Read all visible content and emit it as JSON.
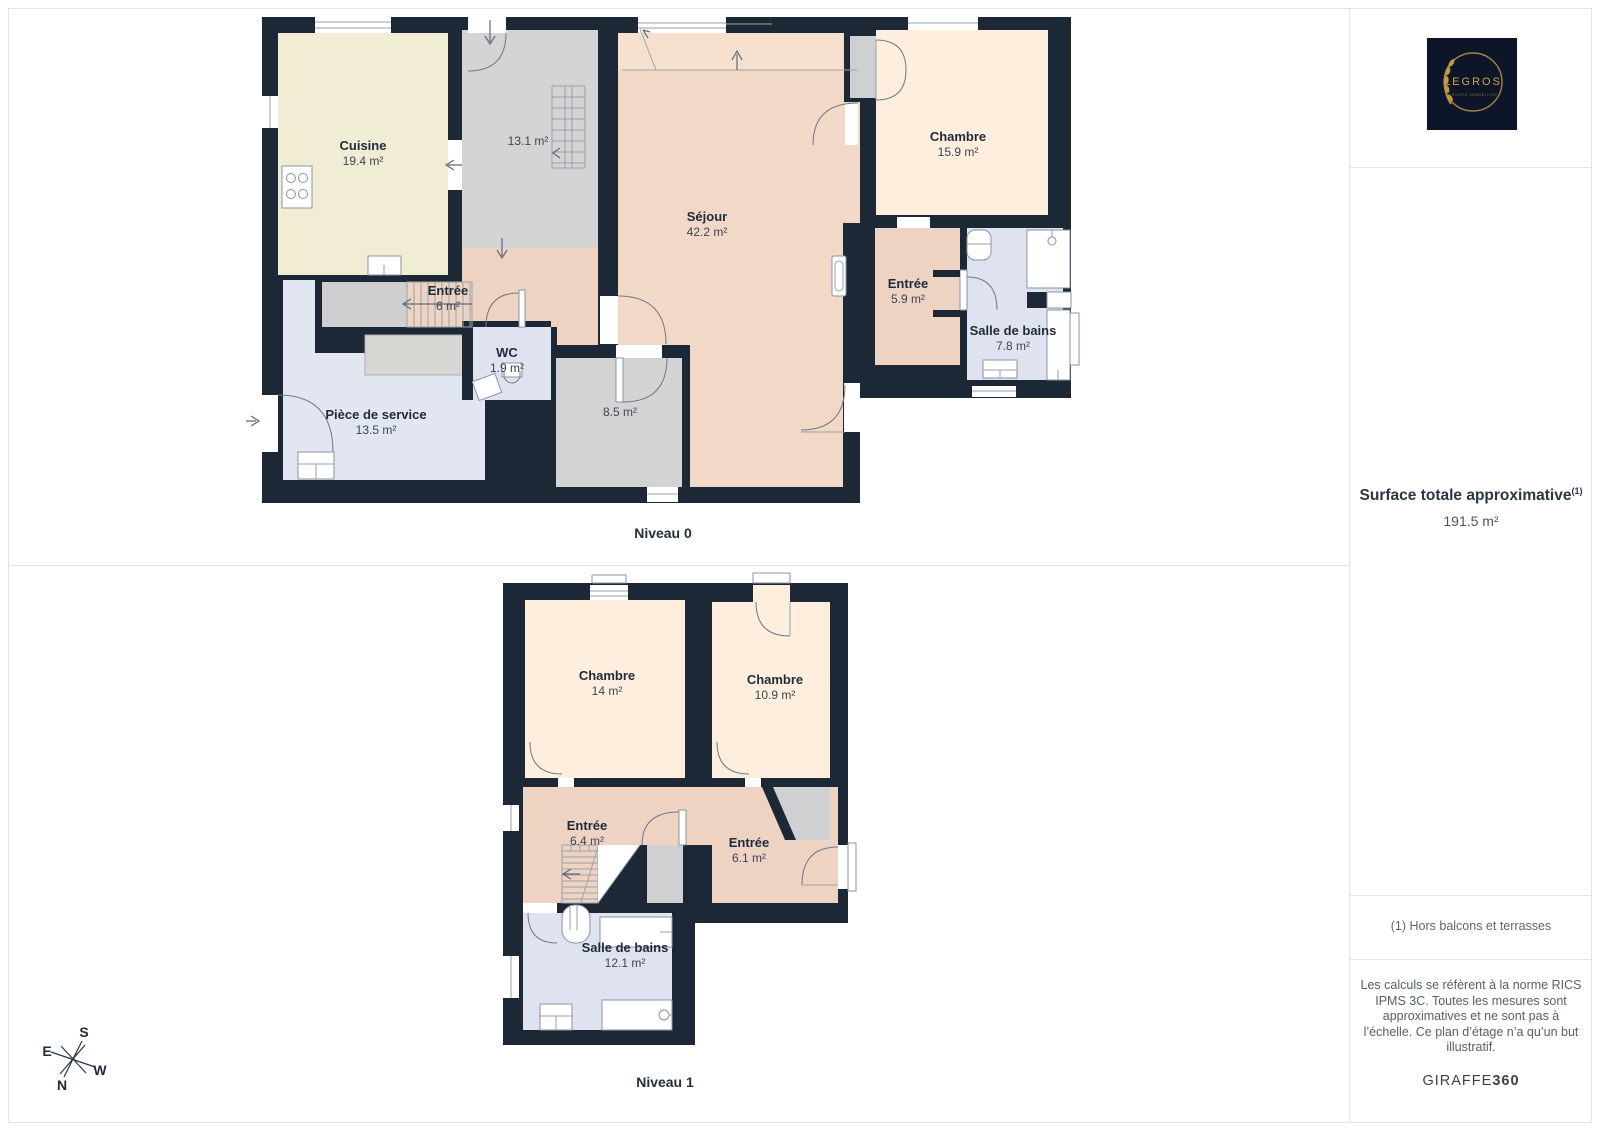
{
  "floors": [
    {
      "name": "Niveau 0",
      "rooms": [
        {
          "id": "cuisine",
          "label": "Cuisine",
          "area": "19.4 m²"
        },
        {
          "id": "degagement",
          "label": "",
          "area": "13.1 m²"
        },
        {
          "id": "sejour",
          "label": "Séjour",
          "area": "42.2 m²"
        },
        {
          "id": "chambre",
          "label": "Chambre",
          "area": "15.9 m²"
        },
        {
          "id": "entree",
          "label": "Entrée",
          "area": "5.9 m²"
        },
        {
          "id": "salle-de-bains",
          "label": "Salle de bains",
          "area": "7.8 m²"
        },
        {
          "id": "entree-escalier",
          "label": "Entrée",
          "area": "6 m²"
        },
        {
          "id": "wc",
          "label": "WC",
          "area": "1.9 m²"
        },
        {
          "id": "piece-de-service",
          "label": "Pièce de service",
          "area": "13.5 m²"
        },
        {
          "id": "piece-8-5",
          "label": "",
          "area": "8.5 m²"
        }
      ]
    },
    {
      "name": "Niveau 1",
      "rooms": [
        {
          "id": "chambre-1",
          "label": "Chambre",
          "area": "14 m²"
        },
        {
          "id": "chambre-2",
          "label": "Chambre",
          "area": "10.9 m²"
        },
        {
          "id": "entree-1",
          "label": "Entrée",
          "area": "6.4 m²"
        },
        {
          "id": "entree-2",
          "label": "Entrée",
          "area": "6.1 m²"
        },
        {
          "id": "salle-de-bains",
          "label": "Salle de bains",
          "area": "12.1 m²"
        }
      ]
    }
  ],
  "sidebar": {
    "logo": {
      "brand": "LEGROS",
      "tagline": "GROUPE IMMOBILIER"
    },
    "surface": {
      "title": "Surface totale approximative",
      "footnote_marker": "(1)",
      "value": "191.5 m²"
    },
    "footnote": "(1) Hors balcons et terrasses",
    "disclaimer": "Les calculs se réfèrent à la norme RICS IPMS 3C. Toutes les mesures sont approximatives et ne sont pas à l’échelle. Ce plan d’étage n’a qu’un but illustratif.",
    "credit_brand": "GIRAFFE",
    "credit_suffix": "360"
  },
  "compass": {
    "north": "N",
    "south": "S",
    "east": "E",
    "west": "W"
  },
  "colors": {
    "wall": "#1c2836",
    "sejour": "#f2d8c7",
    "chambre": "#fdeedd",
    "entree": "#eed3c3",
    "cuisine": "#f1ecd4",
    "bathroom": "#dee3ef",
    "service": "#e2e6f1",
    "hall_gray": "#d4d4d5",
    "accent_gold": "#b08c3e",
    "logo_bg": "#0d1529",
    "text": "#1f2b3a"
  }
}
